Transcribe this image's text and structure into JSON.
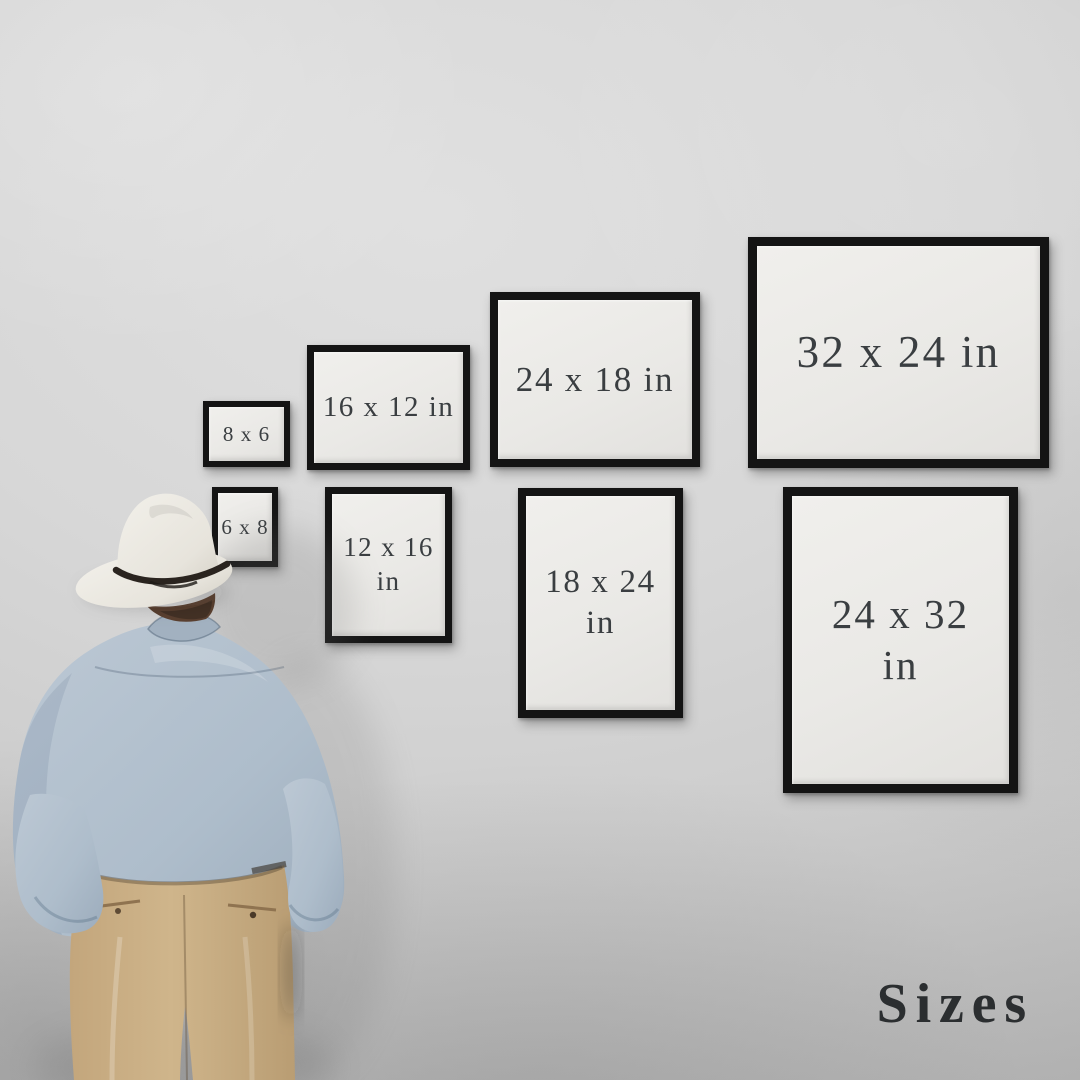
{
  "scene": {
    "title": "Sizes",
    "type": "print-size-guide-mockup",
    "palette": {
      "wall": "#d6d6d6",
      "frame_border": "#141414",
      "frame_face": "#eae9e6",
      "frame_text": "#3a3e41",
      "title_text": "#2b2e30",
      "hat": "#e9e6df",
      "hat_band": "#2a241f",
      "hair": "#5a4030",
      "shirt": "#aebdcb",
      "pants": "#c7ab81"
    }
  },
  "frames": [
    {
      "size": "8 x 6",
      "orientation": "landscape",
      "line1": "8 x 6",
      "line2": ""
    },
    {
      "size": "6 x 8",
      "orientation": "portrait",
      "line1": "6 x 8",
      "line2": ""
    },
    {
      "size": "16 x 12",
      "orientation": "landscape",
      "line1": "16 x 12 in",
      "line2": ""
    },
    {
      "size": "12 x 16",
      "orientation": "portrait",
      "line1": "12 x 16",
      "line2": "in"
    },
    {
      "size": "24 x 18",
      "orientation": "landscape",
      "line1": "24 x 18 in",
      "line2": ""
    },
    {
      "size": "18 x 24",
      "orientation": "portrait",
      "line1": "18 x 24",
      "line2": "in"
    },
    {
      "size": "32 x 24",
      "orientation": "landscape",
      "line1": "32 x 24 in",
      "line2": ""
    },
    {
      "size": "24 x 32",
      "orientation": "portrait",
      "line1": "24 x 32",
      "line2": "in"
    }
  ]
}
